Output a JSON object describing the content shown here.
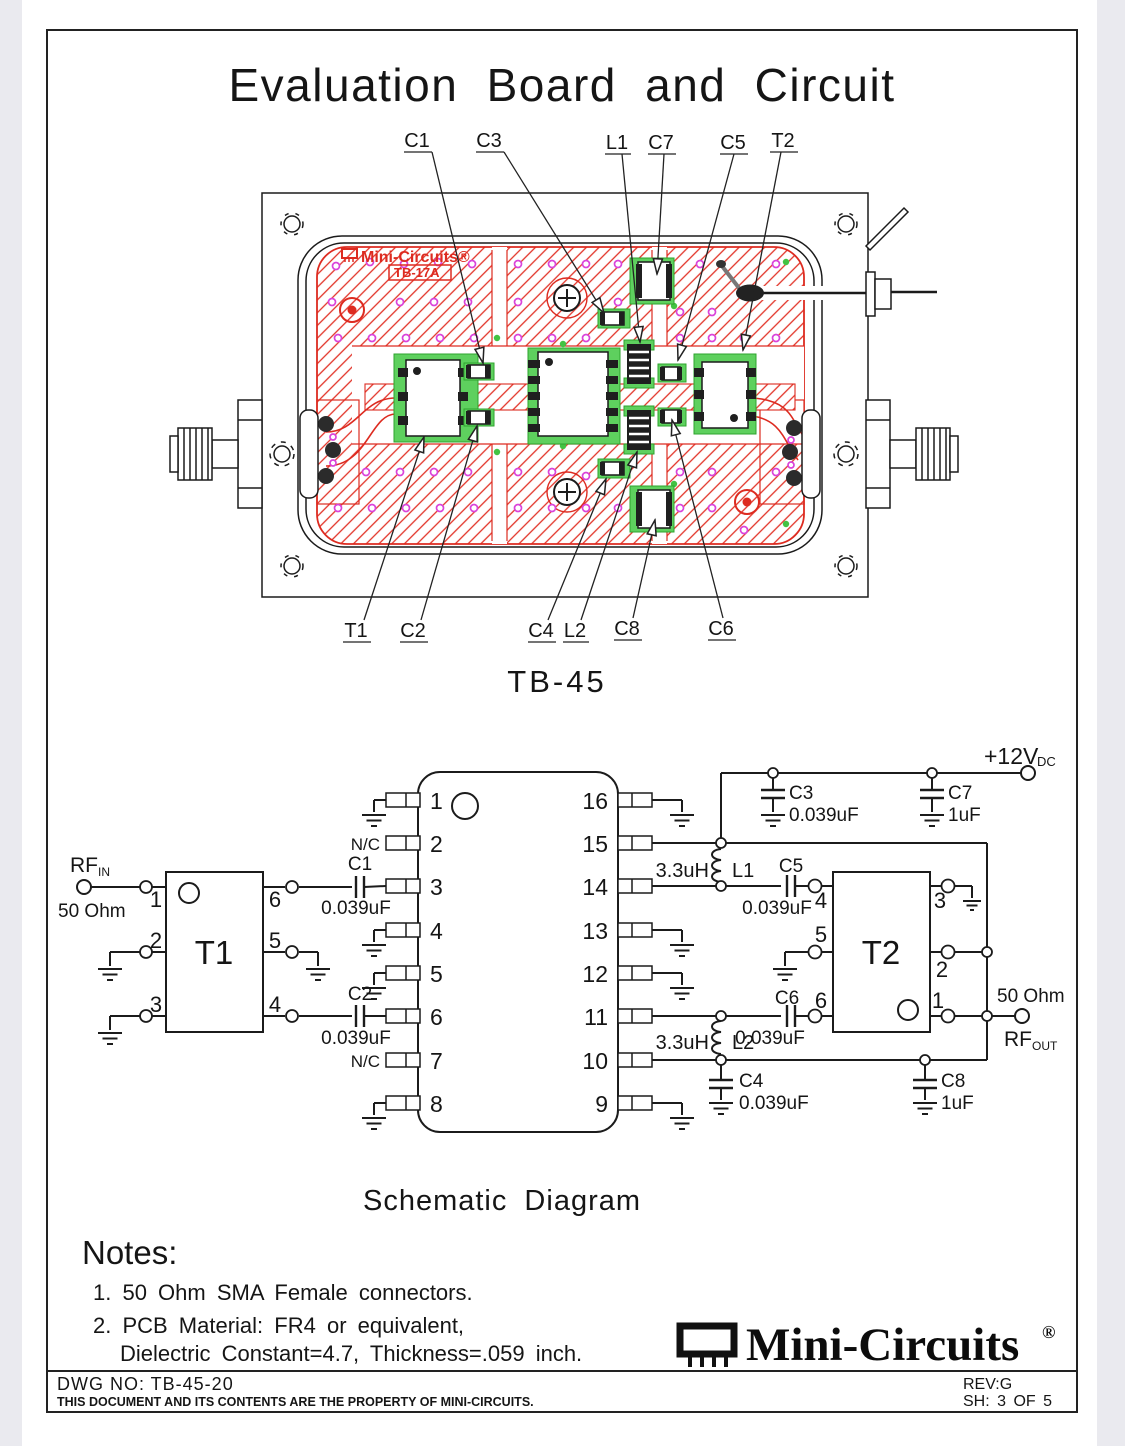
{
  "page": {
    "title": "Evaluation Board and Circuit",
    "board_caption": "TB-45",
    "schematic_caption": "Schematic Diagram"
  },
  "board": {
    "silkscreen": {
      "brand": "Mini-Circuits®",
      "model": "TB-17A"
    },
    "callouts_top": [
      "C1",
      "C3",
      "L1",
      "C7",
      "C5",
      "T2"
    ],
    "callouts_bottom": [
      "T1",
      "C2",
      "C4",
      "L2",
      "C8",
      "C6"
    ]
  },
  "schematic": {
    "ports": {
      "rf_in": {
        "name": "RF",
        "sub": "IN",
        "impedance": "50 Ohm"
      },
      "rf_out": {
        "name": "RF",
        "sub": "OUT",
        "impedance": "50 Ohm"
      },
      "supply": {
        "name": "+12V",
        "sub": "DC"
      }
    },
    "transformer1": {
      "ref": "T1",
      "pins": {
        "left": [
          "1",
          "2",
          "3"
        ],
        "right": [
          "6",
          "5",
          "4"
        ]
      }
    },
    "transformer2": {
      "ref": "T2",
      "pins": {
        "left": [
          "4",
          "5",
          "6"
        ],
        "right": [
          "3",
          "2",
          "1"
        ]
      }
    },
    "amplifier": {
      "pins_left": [
        "1",
        "2",
        "3",
        "4",
        "5",
        "6",
        "7",
        "8"
      ],
      "pins_right": [
        "16",
        "15",
        "14",
        "13",
        "12",
        "11",
        "10",
        "9"
      ],
      "nc": "N/C"
    },
    "caps": {
      "c1": {
        "ref": "C1",
        "value": "0.039uF"
      },
      "c2": {
        "ref": "C2",
        "value": "0.039uF"
      },
      "c3": {
        "ref": "C3",
        "value": "0.039uF"
      },
      "c4": {
        "ref": "C4",
        "value": "0.039uF"
      },
      "c5": {
        "ref": "C5",
        "value": "0.039uF"
      },
      "c6": {
        "ref": "C6",
        "value": "0.039uF"
      },
      "c7": {
        "ref": "C7",
        "value": "1uF"
      },
      "c8": {
        "ref": "C8",
        "value": "1uF"
      }
    },
    "inductors": {
      "l1": {
        "ref": "L1",
        "value": "3.3uH"
      },
      "l2": {
        "ref": "L2",
        "value": "3.3uH"
      }
    }
  },
  "notes": {
    "heading": "Notes:",
    "items": [
      "1.  50 Ohm SMA Female connectors.",
      "2.  PCB Material:  FR4 or equivalent,",
      "Dielectric Constant=4.7,  Thickness=.059 inch."
    ]
  },
  "brand": {
    "name": "Mini-Circuits",
    "reg": "®"
  },
  "footer": {
    "dwg": "DWG NO: TB-45-20",
    "property": "THIS DOCUMENT AND ITS CONTENTS ARE THE PROPERTY OF MINI-CIRCUITS.",
    "rev": "REV:G",
    "sheet": "SH: 3 OF 5"
  },
  "colors": {
    "copper": "#dd2b20",
    "via": "#da43da",
    "pad": "#5ed05e",
    "paper": "#ffffff"
  }
}
